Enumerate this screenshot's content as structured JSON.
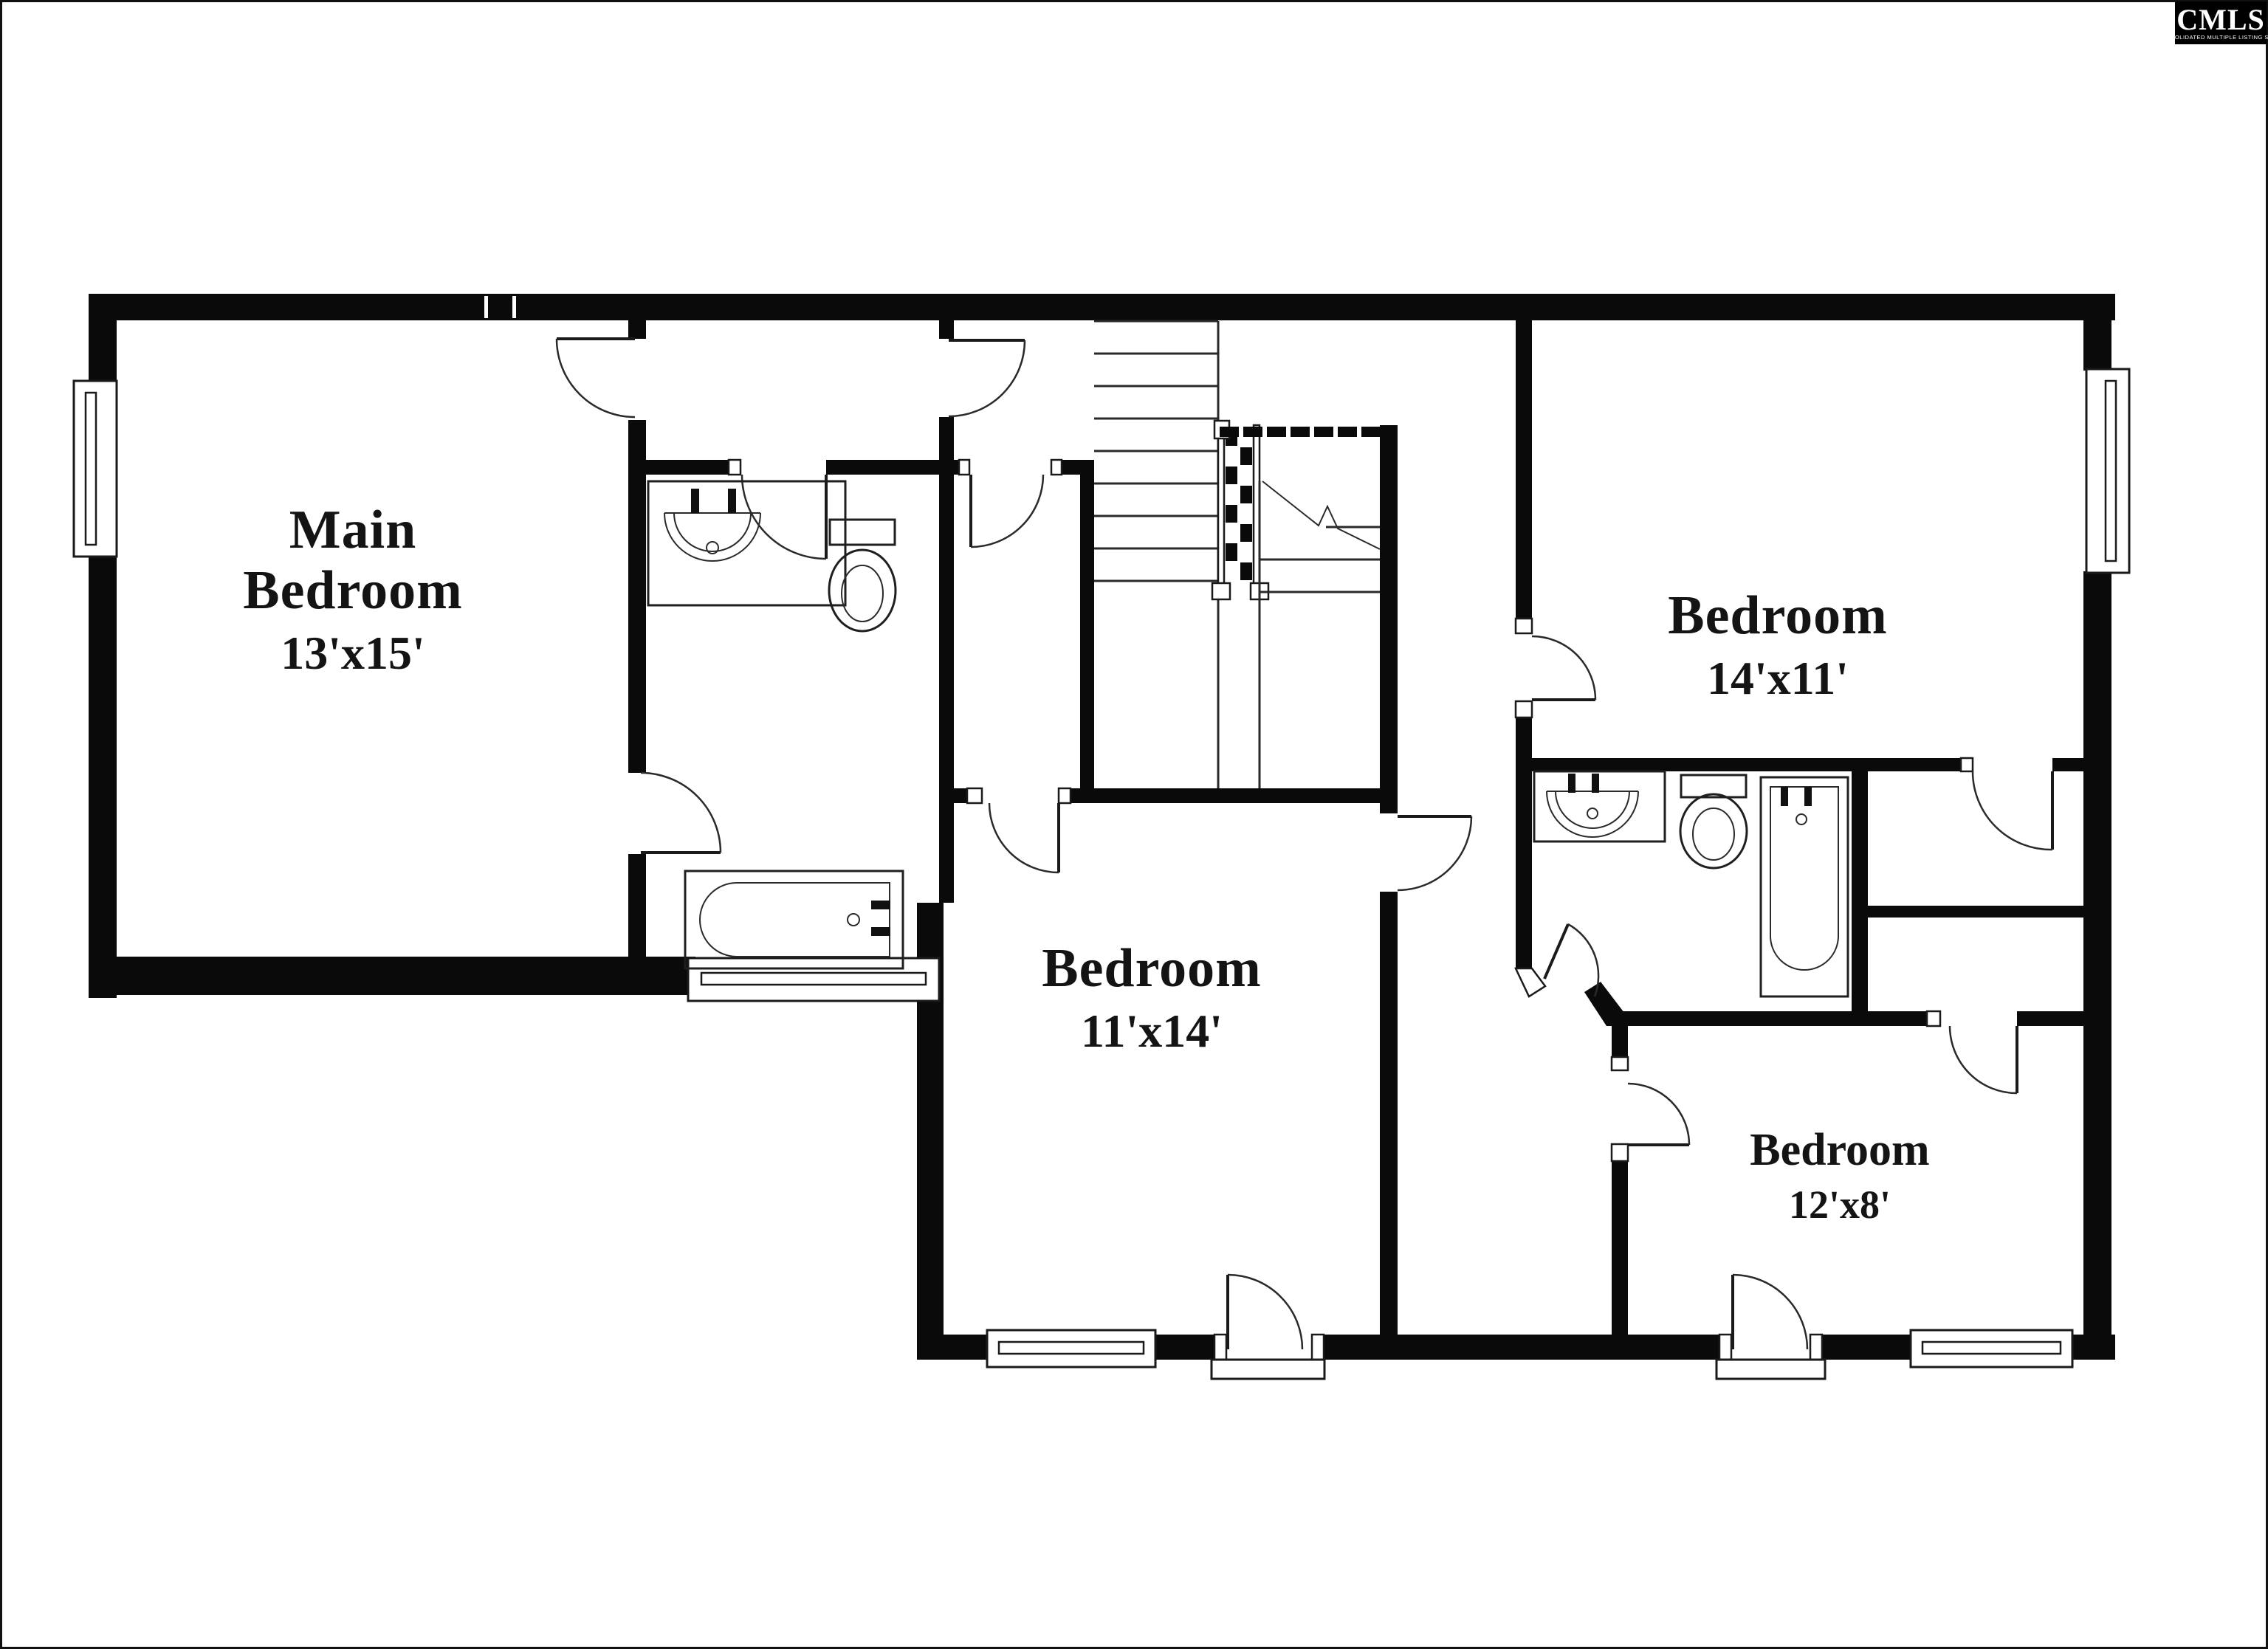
{
  "page": {
    "type": "real-estate floor plan",
    "background": "#ffffff"
  },
  "colors": {
    "wall": "#0a0a0a",
    "label": "#141414",
    "logo_bg": "#000000",
    "logo_fg": "#ffffff"
  },
  "logo": {
    "name": "CMLS",
    "tagline": "CONSOLIDATED MULTIPLE LISTING SERVICE"
  },
  "rooms": [
    {
      "id": "main-bedroom",
      "label_lines": [
        "Main",
        "Bedroom"
      ],
      "dims": "13'x15'"
    },
    {
      "id": "bedroom-northeast",
      "label_lines": [
        "Bedroom"
      ],
      "dims": "14'x11'"
    },
    {
      "id": "bedroom-south",
      "label_lines": [
        "Bedroom"
      ],
      "dims": "11'x14'"
    },
    {
      "id": "bedroom-southeast",
      "label_lines": [
        "Bedroom"
      ],
      "dims": "12'x8'"
    }
  ],
  "fixtures": {
    "left_bathroom": [
      "sink-vanity",
      "toilet",
      "bathtub"
    ],
    "right_bathroom": [
      "sink-vanity",
      "toilet",
      "bathtub"
    ],
    "stairs": [
      "treads",
      "checkered-railing",
      "break-line",
      "dashed-opening-line"
    ]
  },
  "openings": {
    "windows": 5,
    "doors": 13
  }
}
